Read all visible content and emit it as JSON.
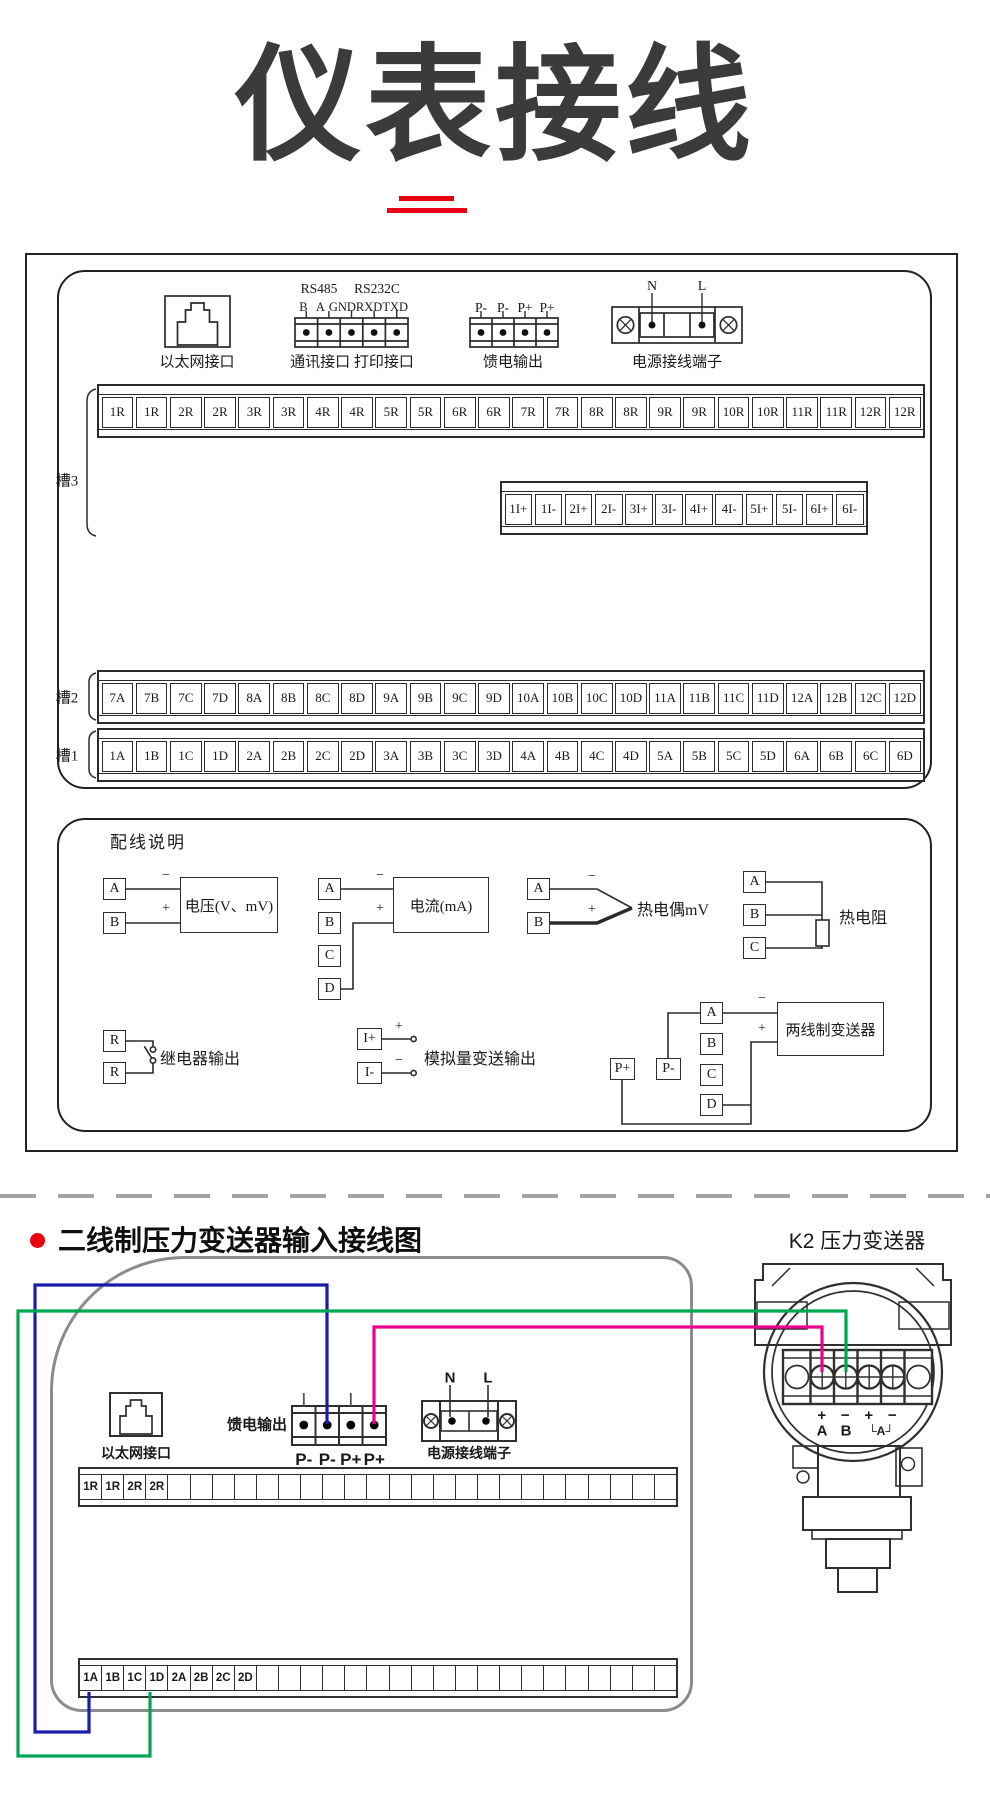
{
  "page": {
    "title": "仪表接线"
  },
  "section1": {
    "connectors": {
      "ethernet_label": "以太网接口",
      "rs485": "RS485",
      "rs232c": "RS232C",
      "comm_pins": [
        "B",
        "A",
        "GND",
        "RXD",
        "TXD"
      ],
      "comm_label": "通讯接口 打印接口",
      "feed_pins": [
        "P-",
        "P-",
        "P+",
        "P+"
      ],
      "feed_label": "馈电输出",
      "power_n": "N",
      "power_l": "L",
      "power_label": "电源接线端子"
    },
    "slots": {
      "slot3": {
        "label": "槽3",
        "cells": [
          "1R",
          "1R",
          "2R",
          "2R",
          "3R",
          "3R",
          "4R",
          "4R",
          "5R",
          "5R",
          "6R",
          "6R",
          "7R",
          "7R",
          "8R",
          "8R",
          "9R",
          "9R",
          "10R",
          "10R",
          "11R",
          "11R",
          "12R",
          "12R"
        ]
      },
      "current_loop": {
        "cells": [
          "1I+",
          "1I-",
          "2I+",
          "2I-",
          "3I+",
          "3I-",
          "4I+",
          "4I-",
          "5I+",
          "5I-",
          "6I+",
          "6I-"
        ]
      },
      "slot2": {
        "label": "槽2",
        "cells": [
          "7A",
          "7B",
          "7C",
          "7D",
          "8A",
          "8B",
          "8C",
          "8D",
          "9A",
          "9B",
          "9C",
          "9D",
          "10A",
          "10B",
          "10C",
          "10D",
          "11A",
          "11B",
          "11C",
          "11D",
          "12A",
          "12B",
          "12C",
          "12D"
        ]
      },
      "slot1": {
        "label": "槽1",
        "cells": [
          "1A",
          "1B",
          "1C",
          "1D",
          "2A",
          "2B",
          "2C",
          "2D",
          "3A",
          "3B",
          "3C",
          "3D",
          "4A",
          "4B",
          "4C",
          "4D",
          "5A",
          "5B",
          "5C",
          "5D",
          "6A",
          "6B",
          "6C",
          "6D"
        ]
      }
    },
    "wiring": {
      "title": "配线说明",
      "voltage": {
        "t1": "A",
        "t2": "B",
        "minus": "−",
        "plus": "+",
        "device": "电压(V、mV)"
      },
      "current": {
        "t1": "A",
        "t2": "B",
        "t3": "C",
        "t4": "D",
        "minus": "−",
        "plus": "+",
        "device": "电流(mA)"
      },
      "thermocouple": {
        "t1": "A",
        "t2": "B",
        "minus": "−",
        "plus": "+",
        "label": "热电偶mV"
      },
      "rtd": {
        "t1": "A",
        "t2": "B",
        "t3": "C",
        "label": "热电阻"
      },
      "relay": {
        "t1": "R",
        "t2": "R",
        "label": "继电器输出"
      },
      "analog": {
        "t1": "I+",
        "t2": "I-",
        "plus": "+",
        "minus": "−",
        "label": "模拟量变送输出"
      },
      "two_wire": {
        "p_plus": "P+",
        "p_minus": "P-",
        "t1": "A",
        "t2": "B",
        "t3": "C",
        "t4": "D",
        "minus": "−",
        "plus": "+",
        "device": "两线制变送器"
      }
    }
  },
  "section2": {
    "heading": "二线制压力变送器输入接线图",
    "transmitter_title": "K2 压力变送器",
    "ethernet_label": "以太网接口",
    "feed_label": "馈电输出",
    "feed_pins": [
      "P-",
      "P-",
      "P+",
      "P+"
    ],
    "power_n": "N",
    "power_l": "L",
    "power_label": "电源接线端子",
    "row_top": [
      "1R",
      "1R",
      "2R",
      "2R",
      "",
      "",
      "",
      "",
      "",
      "",
      "",
      "",
      "",
      "",
      "",
      "",
      "",
      "",
      "",
      "",
      "",
      "",
      "",
      "",
      "",
      "",
      ""
    ],
    "row_bottom": [
      "1A",
      "1B",
      "1C",
      "1D",
      "2A",
      "2B",
      "2C",
      "2D",
      "",
      "",
      "",
      "",
      "",
      "",
      "",
      "",
      "",
      "",
      "",
      "",
      "",
      "",
      "",
      "",
      "",
      "",
      ""
    ],
    "transmitter": {
      "marks": [
        "+",
        "−",
        "+",
        "−"
      ],
      "a": "A",
      "b": "B",
      "loop": "└A┘"
    }
  },
  "colors": {
    "accent_red": "#e60012",
    "wire_blue": "#1c1caa",
    "wire_green": "#00a651",
    "wire_magenta": "#ec008c",
    "panel_gray": "#8c8c8c",
    "line_dark": "#2b2b2b"
  }
}
